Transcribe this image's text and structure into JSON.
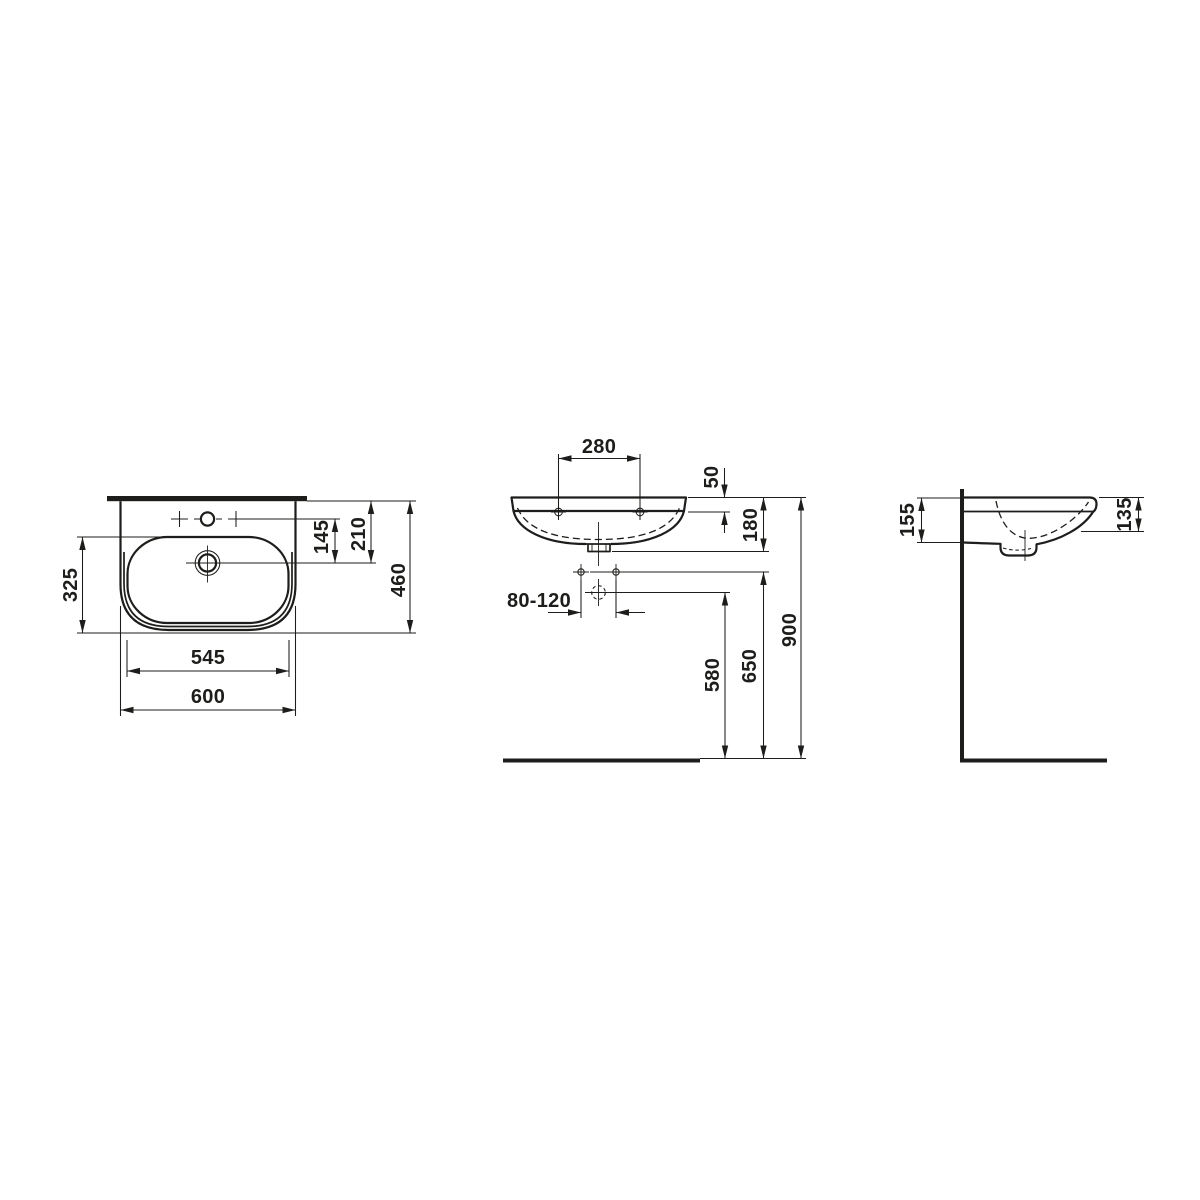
{
  "title": "Washbasin technical dimension drawing",
  "colors": {
    "background": "#ffffff",
    "line": "#1d1d1b"
  },
  "views": {
    "plan": {
      "name": "top view",
      "labels": {
        "bowl_depth": "325",
        "tap_to_drain": "145",
        "back_to_drain": "210",
        "overall_depth": "460",
        "bowl_width": "545",
        "overall_width": "600"
      }
    },
    "front": {
      "name": "front view",
      "labels": {
        "tap_hole_spacing": "280",
        "rim_to_tap_holes": "50",
        "rim_to_bowl_bottom": "180",
        "fixing_hole_range": "80-120",
        "floor_to_waste": "580",
        "floor_to_fixing_holes": "650",
        "floor_to_rim": "900"
      }
    },
    "side": {
      "name": "side view",
      "labels": {
        "rear_height": "155",
        "front_height": "135"
      }
    }
  }
}
